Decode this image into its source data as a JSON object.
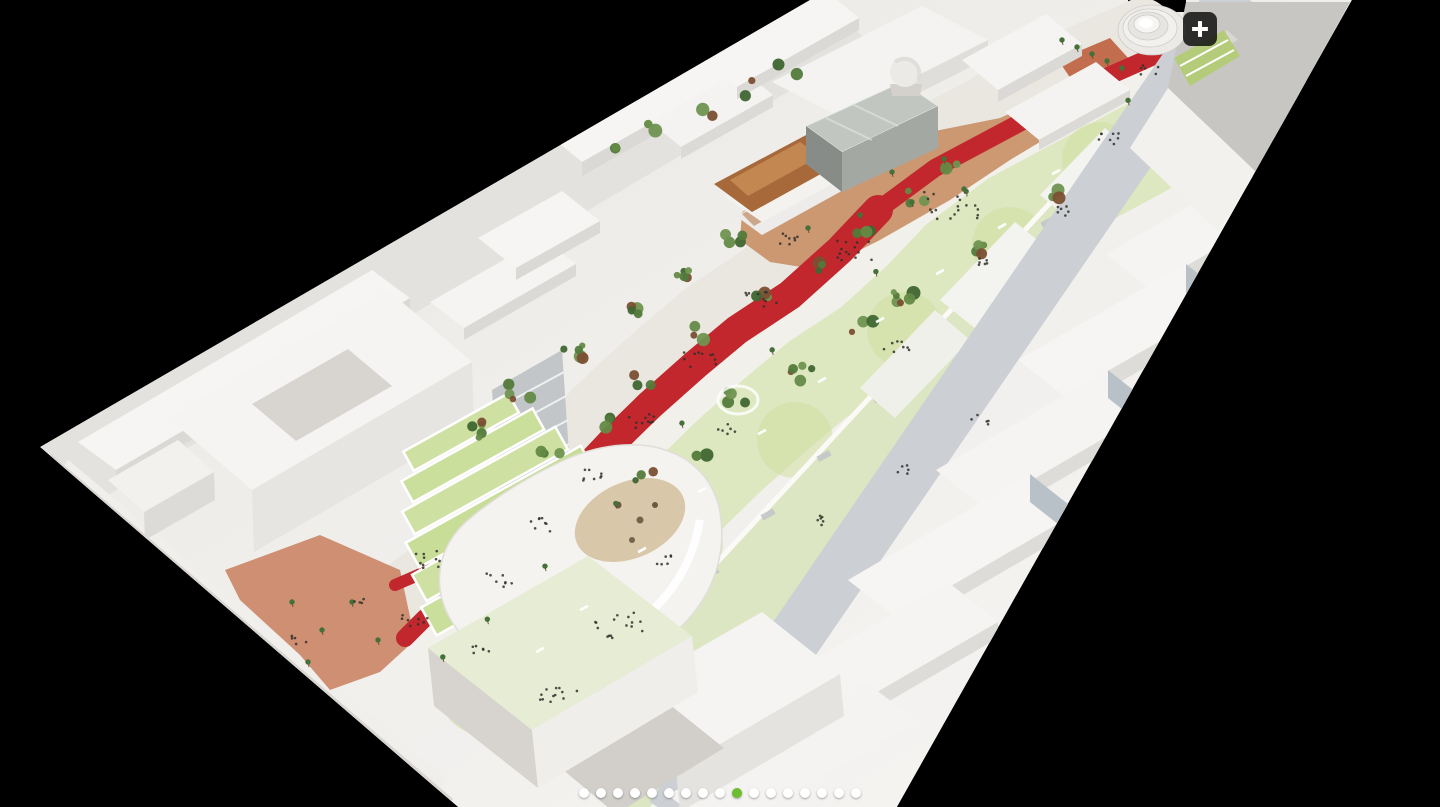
{
  "viewer": {
    "background_color": "#000000",
    "photo": {
      "description": "Aerial photograph of a white architectural scale model of an urban masterplan: a long linear park with pale green lawns, dense trees, palm trees and a winding red promenade running between rows of white city blocks; landmark buildings include a reflective metal cube, a copper-roofed pavilion, a white dome, a white spiral tower and a terraced green amphitheatre building with an oval void, all photographed against a black background.",
      "colors": {
        "model_white": "#f1efec",
        "lawn_green": "#dde7c0",
        "promenade_red": "#c1272d",
        "copper_bronze": "#a8693a",
        "terracotta": "#c7895e",
        "street_grey": "#ccd0d4",
        "tree_green": "#527a3b"
      }
    },
    "zoom_button": {
      "label": "+",
      "background": "#111111"
    },
    "carousel": {
      "dots_total": 17,
      "active_slide": 10,
      "active_color": "#6cbe30",
      "inactive_color": "#ffffff"
    }
  }
}
